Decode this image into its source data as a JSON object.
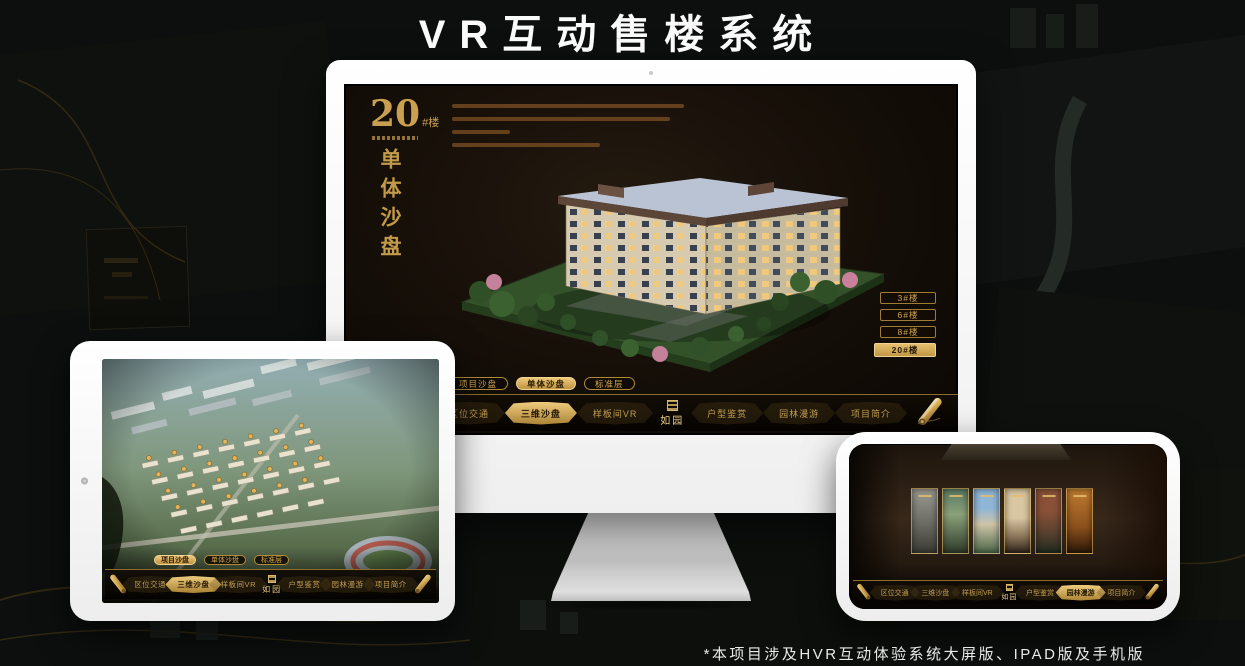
{
  "page": {
    "title": "VR互动售楼系统",
    "footnote": "*本项目涉及HVR互动体验系统大屏版、IPAD版及手机版"
  },
  "colors": {
    "accent_gold": "#c9a050",
    "selected_gold": "#d8b15f",
    "screen_bg": "#16100a",
    "device_white": "#f4f4f4",
    "title_white": "#fafafa"
  },
  "monitor_app": {
    "header": {
      "building_number": "20",
      "building_suffix": "#楼",
      "section_title_vertical": "单体沙盘"
    },
    "floor_buttons": [
      {
        "label": "3#楼",
        "selected": false
      },
      {
        "label": "6#楼",
        "selected": false
      },
      {
        "label": "8#楼",
        "selected": false
      },
      {
        "label": "20#楼",
        "selected": true
      }
    ],
    "sub_tabs": [
      {
        "label": "项目沙盘",
        "selected": false
      },
      {
        "label": "单体沙盘",
        "selected": true
      },
      {
        "label": "标准层",
        "selected": false
      }
    ],
    "nav": {
      "logo": "如园",
      "items": [
        {
          "label": "区位交通",
          "selected": false
        },
        {
          "label": "三维沙盘",
          "selected": true
        },
        {
          "label": "样板间VR",
          "selected": false
        },
        {
          "label": "户型鉴赏",
          "selected": false
        },
        {
          "label": "园林漫游",
          "selected": false
        },
        {
          "label": "项目简介",
          "selected": false
        }
      ]
    }
  },
  "tablet_app": {
    "sub_tabs": [
      {
        "label": "项目沙盘",
        "selected": true
      },
      {
        "label": "单体沙盘",
        "selected": false
      },
      {
        "label": "标准层",
        "selected": false
      }
    ],
    "nav": {
      "logo": "如园",
      "items": [
        {
          "label": "区位交通",
          "selected": false
        },
        {
          "label": "三维沙盘",
          "selected": true
        },
        {
          "label": "样板间VR",
          "selected": false
        },
        {
          "label": "户型鉴赏",
          "selected": false
        },
        {
          "label": "园林漫游",
          "selected": false
        },
        {
          "label": "项目简介",
          "selected": false
        }
      ]
    }
  },
  "phone_app": {
    "nav": {
      "logo": "如园",
      "items": [
        {
          "label": "区位交通",
          "selected": false
        },
        {
          "label": "三维沙盘",
          "selected": false
        },
        {
          "label": "样板间VR",
          "selected": false
        },
        {
          "label": "户型鉴赏",
          "selected": false
        },
        {
          "label": "园林漫游",
          "selected": true
        },
        {
          "label": "项目简介",
          "selected": false
        }
      ]
    }
  }
}
